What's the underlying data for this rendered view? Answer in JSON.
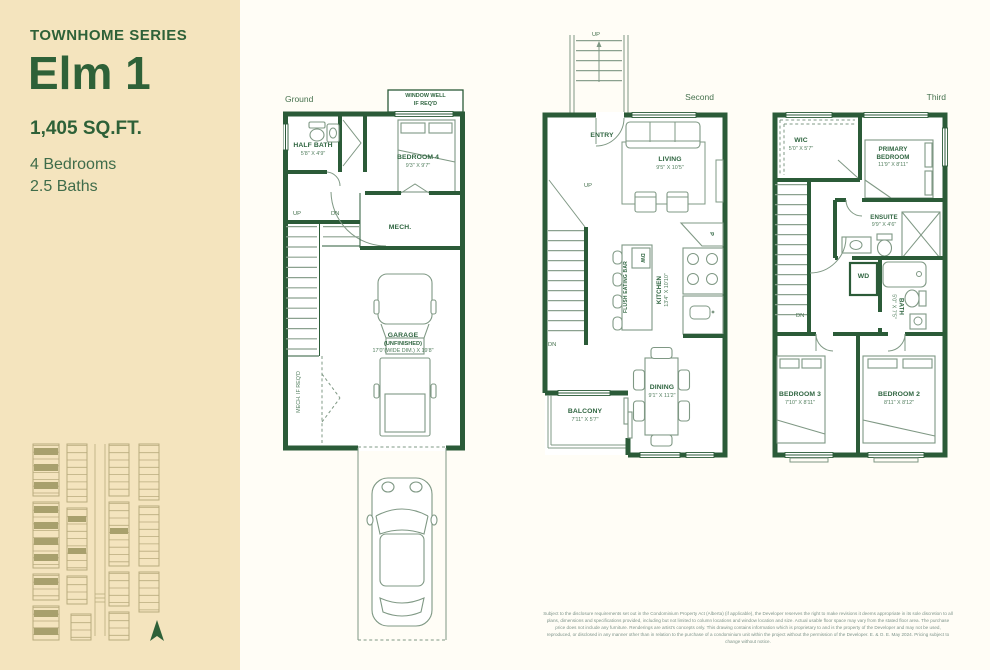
{
  "colors": {
    "wall_green": "#2b5b38",
    "accent_green": "#2e6138",
    "sidebar_bg": "#f4e4be",
    "main_bg": "#fffdf6",
    "site_olive": "#a8a06d"
  },
  "icons": {
    "north_arrow": "north-arrow-icon",
    "car": "car-icon",
    "truck": "truck-icon",
    "bed": "bed-icon"
  },
  "sidebar": {
    "series_label": "TOWNHOME SERIES",
    "plan_name": "Elm 1",
    "area": "1,405 SQ.FT.",
    "bedrooms": "4 Bedrooms",
    "baths": "2.5 Baths"
  },
  "floors": {
    "ground": {
      "label": "Ground",
      "window_well_line1": "WINDOW WELL",
      "window_well_line2": "IF REQ'D",
      "rooms": {
        "half_bath": {
          "name": "HALF BATH",
          "dims": "5'8\" X 4'9\""
        },
        "bedroom4": {
          "name": "BEDROOM 4",
          "dims": "9'3\" X 9'7\""
        },
        "mech": {
          "name": "MECH."
        },
        "garage": {
          "name": "GARAGE",
          "sub": "(UNFINISHED)",
          "dims": "17'0\"(WIDE DIM.) X 19'8\""
        }
      },
      "notes": {
        "mech_if_reqd": "MECH. IF REQ'D"
      },
      "stairs": {
        "up": "UP",
        "dn": "DN"
      }
    },
    "second": {
      "label": "Second",
      "entry_stairs_up": "UP",
      "rooms": {
        "entry": {
          "name": "ENTRY"
        },
        "living": {
          "name": "LIVING",
          "dims": "9'5\" X 10'5\""
        },
        "kitchen": {
          "name": "KITCHEN",
          "dims": "13'4\" X 10'10\""
        },
        "eating_bar": {
          "name": "FLUSH EATING BAR"
        },
        "dishwasher": {
          "name": "DW"
        },
        "pantry": {
          "name": "P"
        },
        "dining": {
          "name": "DINING",
          "dims": "9'1\" X 11'2\""
        },
        "balcony": {
          "name": "BALCONY",
          "dims": "7'11\" X 5'7\""
        }
      },
      "stairs": {
        "up": "UP",
        "dn": "DN"
      }
    },
    "third": {
      "label": "Third",
      "rooms": {
        "wic": {
          "name": "WIC",
          "dims": "5'0\" X 5'7\""
        },
        "primary_bedroom": {
          "name": "PRIMARY BEDROOM",
          "dims": "11'9\" X 8'11\""
        },
        "ensuite": {
          "name": "ENSUITE",
          "dims": "9'9\" X 4'6\""
        },
        "laundry": {
          "name": "WD"
        },
        "bath": {
          "name": "BATH",
          "dims": "5'0\" X 7'5\""
        },
        "bedroom3": {
          "name": "BEDROOM 3",
          "dims": "7'10\" X 8'11\""
        },
        "bedroom2": {
          "name": "BEDROOM 2",
          "dims": "8'11\" X 8'12\""
        }
      },
      "stairs": {
        "dn": "DN"
      }
    }
  },
  "disclaimer": "Subject to the disclosure requirements set out in the Condominium Property Act (Alberta) (if applicable), the Developer reserves the right to make revisions it deems appropriate in its sole discretion to all plans, dimensions and specifications provided, including but not limited to column locations and window location and size. Actual usable floor space may vary from the stated floor area. The purchase price does not include any furniture. Renderings are artist's concepts only. This drawing contains information which is proprietary to and is the property of the Developer and may not be used, reproduced, or disclosed in any manner other than in relation to the purchase of a condominium unit within the project without the permission of the Developer. E. & O. E. May 2024. Pricing subject to change without notice."
}
